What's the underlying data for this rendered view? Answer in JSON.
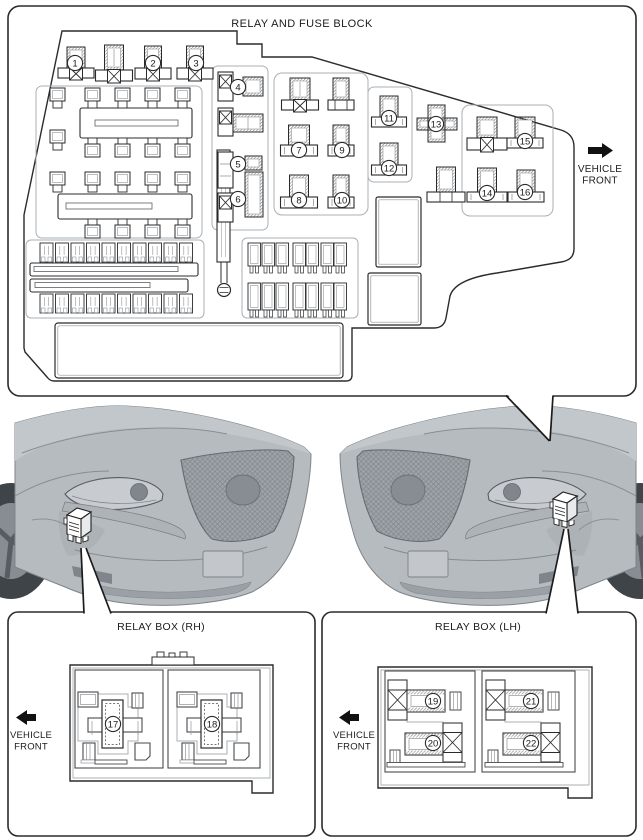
{
  "fuse_block": {
    "title": "RELAY AND FUSE BLOCK",
    "vehicle_front": "VEHICLE FRONT",
    "callouts": [
      "1",
      "2",
      "3",
      "4",
      "5",
      "6",
      "7",
      "8",
      "9",
      "10",
      "11",
      "12",
      "13",
      "14",
      "15",
      "16"
    ]
  },
  "relay_box_rh": {
    "title": "RELAY BOX (RH)",
    "vehicle_front": "VEHICLE FRONT",
    "callouts": [
      "17",
      "18"
    ]
  },
  "relay_box_lh": {
    "title": "RELAY BOX (LH)",
    "vehicle_front": "VEHICLE FRONT",
    "callouts": [
      "19",
      "20",
      "21",
      "22"
    ]
  },
  "colors": {
    "line": "#2b2b2b",
    "mid_line": "#5a5f64",
    "gray_line": "#8f959a",
    "housing_line": "#aab0b5",
    "car_body": "#b6bbc0",
    "car_hood": "#c2c7cc",
    "car_grille": "#9ea3a8",
    "tire": "#3f4449",
    "background": "#ffffff"
  }
}
